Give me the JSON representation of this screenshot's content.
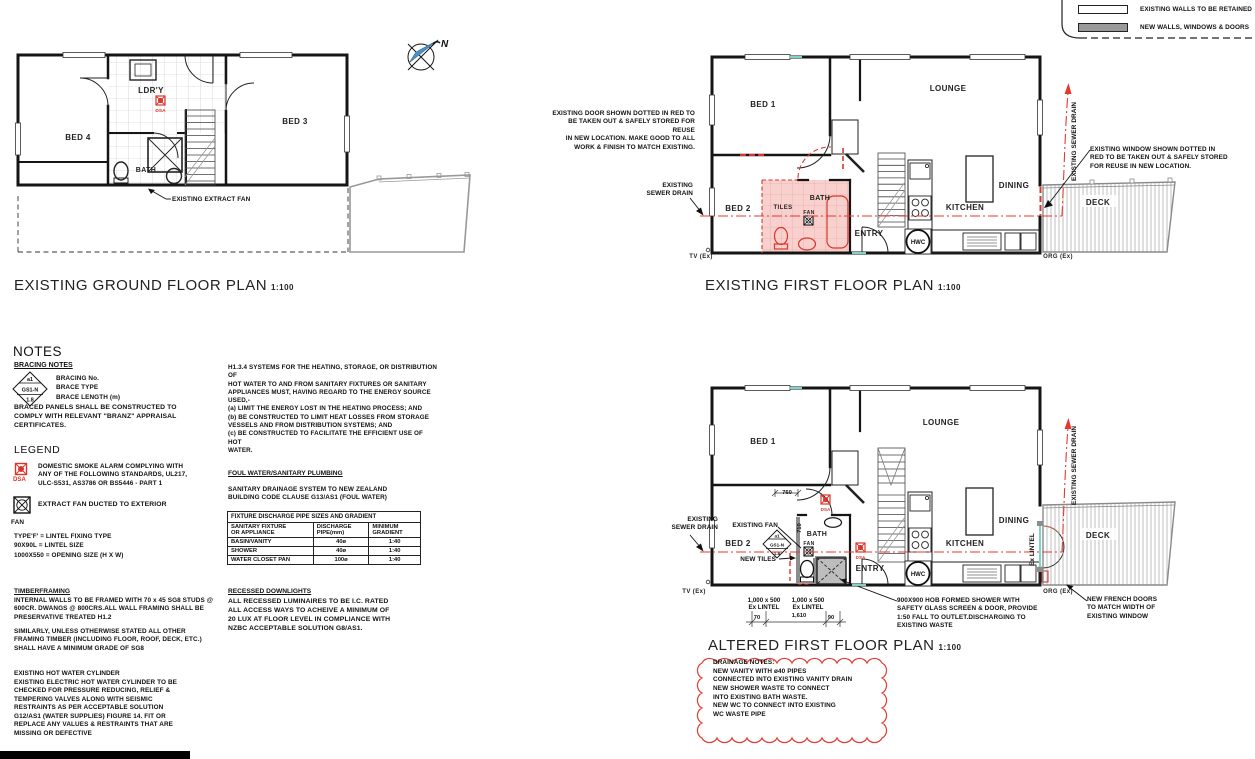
{
  "wall_legend": {
    "existing_label": "EXISTING WALLS TO BE RETAINED",
    "new_label": "NEW WALLS, WINDOWS & DOORS"
  },
  "ground_plan": {
    "title": "EXISTING GROUND FLOOR PLAN",
    "scale": "1:100",
    "north": "N",
    "labels": {
      "bed4": "BED 4",
      "bed3": "BED 3",
      "ldry": "LDR'Y",
      "bath": "BATH",
      "dsa": "DSA",
      "extract_fan_note": "EXISTING EXTRACT FAN"
    }
  },
  "first_plan": {
    "title": "EXISTING FIRST FLOOR PLAN",
    "scale": "1:100",
    "labels": {
      "bed1": "BED 1",
      "bed2": "BED 2",
      "lounge": "LOUNGE",
      "dining": "DINING",
      "kitchen": "KITCHEN",
      "bath": "BATH",
      "tiles": "TILES",
      "fan": "FAN",
      "entry": "ENTRY",
      "deck": "DECK",
      "hwc": "HWC",
      "tv": "TV (Ex)",
      "org": "ORG (Ex)"
    },
    "notes": {
      "door_note": "EXISTING DOOR SHOWN DOTTED IN RED TO\nBE TAKEN OUT & SAFELY STORED FOR REUSE\nIN NEW LOCATION. MAKE GOOD TO ALL\nWORK & FINISH TO MATCH EXISTING.",
      "sewer_left": "EXISTING\nSEWER DRAIN",
      "sewer_right": "EXISTING SEWER DRAIN",
      "window_note": "EXISTING WINDOW SHOWN DOTTED IN\nRED TO BE TAKEN OUT & SAFELY STORED\nFOR REUSE IN NEW LOCATION."
    }
  },
  "altered_plan": {
    "title": "ALTERED FIRST FLOOR PLAN",
    "scale": "1:100",
    "labels": {
      "bed1": "BED 1",
      "bed2": "BED 2",
      "lounge": "LOUNGE",
      "dining": "DINING",
      "kitchen": "KITCHEN",
      "bath": "BATH",
      "fan": "FAN",
      "entry": "ENTRY",
      "deck": "DECK",
      "hwc": "HWC",
      "dsa": "DSA",
      "tv": "TV (Ex)",
      "org": "ORG (Ex)"
    },
    "bracing_tag": {
      "no": "a1",
      "type": "GS1-N",
      "len": "1.8"
    },
    "dims": {
      "d760": "760",
      "d710": "710",
      "d70": "70",
      "d1610": "1,610",
      "d90": "90",
      "lintel1": "1,000 x 500\nEx LINTEL",
      "lintel2": "1,000 x 500\nEx LINTEL",
      "ex_lintel_v": "Ex LINTEL"
    },
    "notes": {
      "sewer_left": "EXISTING\nSEWER DRAIN",
      "existing_fan": "EXISTING FAN",
      "new_tiles": "NEW TILES",
      "shower_note": "900X900 HOB FORMED SHOWER WITH\nSAFETY GLASS SCREEN & DOOR, PROVIDE\n1:50 FALL TO OUTLET.DISCHARGING TO\nEXISTING WASTE",
      "french_doors": "NEW FRENCH DOORS\nTO MATCH WIDTH OF\nEXISTING WINDOW",
      "sewer_right": "EXISTING SEWER DRAIN"
    },
    "cloud": "DRAINAGE NOTES:\nNEW VANITY WITH ø40 PIPES\nCONNECTED INTO EXISTING VANITY DRAIN\nNEW SHOWER WASTE TO CONNECT\nINTO EXISTING BATH WASTE.\nNEW WC TO CONNECT INTO EXISTING\nWC WASTE PIPE"
  },
  "notes_panel": {
    "heading": "NOTES",
    "bracing_heading": "BRACING NOTES",
    "bracing_tag": {
      "no": "a1",
      "type": "GS1-N",
      "len": "1.8"
    },
    "bracing_key": "BRACING No.\nBRACE TYPE\nBRACE LENGTH (m)",
    "braced_panels": "BRACED PANELS SHALL BE CONSTRUCTED TO\nCOMPLY WITH RELEVANT \"BRANZ\" APPRAISAL\nCERTIFICATES.",
    "legend_heading": "LEGEND",
    "dsa_label": "DSA",
    "smoke_alarm": "DOMESTIC SMOKE ALARM COMPLYING WITH\nANY OF THE FOLLOWING STANDARDS, UL217,\nULC-S531, AS3786 OR BS5446 - PART 1",
    "extract_fan": "EXTRACT FAN DUCTED TO EXTERIOR",
    "fan_label": "FAN",
    "lintel_key": "TYPE'F' = LINTEL FIXING TYPE\n90X90L = LINTEL SIZE\n1000X550 = OPENING SIZE (H X W)",
    "timber_heading": "TIMBERFRAMING",
    "timber_body": "INTERNAL WALLS TO BE FRAMED WITH 70 x 45 SG8 STUDS @\n600CR. DWANGS @ 800CRS.ALL WALL FRAMING SHALL BE\nPRESERVATIVE TREATED H1.2",
    "timber_body2": "SIMILARLY, UNLESS OTHERWISE STATED ALL OTHER\nFRAMING TIMBER (INCLUDING FLOOR, ROOF, DECK, ETC.)\nSHALL HAVE A MINIMUM GRADE OF SG8",
    "hwc_heading": "EXISTING HOT WATER CYLINDER",
    "hwc_body": "EXISTING ELECTRIC HOT WATER CYLINDER TO BE\nCHECKED FOR PRESSURE REDUCING, RELIEF &\nTEMPERING VALVES ALONG WITH SEISMIC\nRESTRAINTS AS PER ACCEPTABLE SOLUTION\nG12/AS1 (WATER SUPPLIES) FIGURE 14. FIT OR\nREPLACE ANY VALUES & RESTRAINTS THAT ARE\nMISSING OR DEFECTIVE"
  },
  "plumbing_panel": {
    "h1_note": "H1.3.4 SYSTEMS FOR THE HEATING, STORAGE, OR DISTRIBUTION OF\nHOT WATER TO AND FROM SANITARY FIXTURES OR SANITARY\nAPPLIANCES MUST, HAVING REGARD TO THE ENERGY SOURCE\nUSED,-\n(a) LIMIT THE ENERGY LOST IN THE HEATING PROCESS; AND\n(b) BE CONSTRUCTED TO LIMIT HEAT LOSSES FROM STORAGE\nVESSELS AND FROM DISTRIBUTION SYSTEMS; AND\n(c) BE CONSTRUCTED TO FACILITATE THE EFFICIENT USE OF HOT\nWATER.",
    "foul_heading": "FOUL WATER/SANITARY PLUMBING",
    "foul_body": "SANITARY DRAINAGE SYSTEM TO NEW ZEALAND\nBUILDING CODE CLAUSE G13/AS1 (FOUL WATER)",
    "table": {
      "title": "FIXTURE DISCHARGE PIPE SIZES AND GRADIENT",
      "col1": "SANITARY FIXTURE\nOR APPLIANCE",
      "col2": "DISCHARGE\nPIPE(mm)",
      "col3": "MINIMUM\nGRADIENT",
      "rows": [
        {
          "fixture": "BASIN/VANITY",
          "pipe": "40ø",
          "gradient": "1:40"
        },
        {
          "fixture": "SHOWER",
          "pipe": "40ø",
          "gradient": "1:40"
        },
        {
          "fixture": "WATER CLOSET PAN",
          "pipe": "100ø",
          "gradient": "1:40"
        }
      ]
    },
    "downlights_heading": "RECESSED DOWNLIGHTS",
    "downlights_body": "ALL RECESSED LUMINAIRES TO BE I.C. RATED\nALL ACCESS WAYS TO ACHEIVE A MINIMUM OF\n20 LUX AT FLOOR LEVEL IN COMPLIANCE WITH\nNZBC ACCEPTABLE SOLUTION G8/AS1."
  }
}
